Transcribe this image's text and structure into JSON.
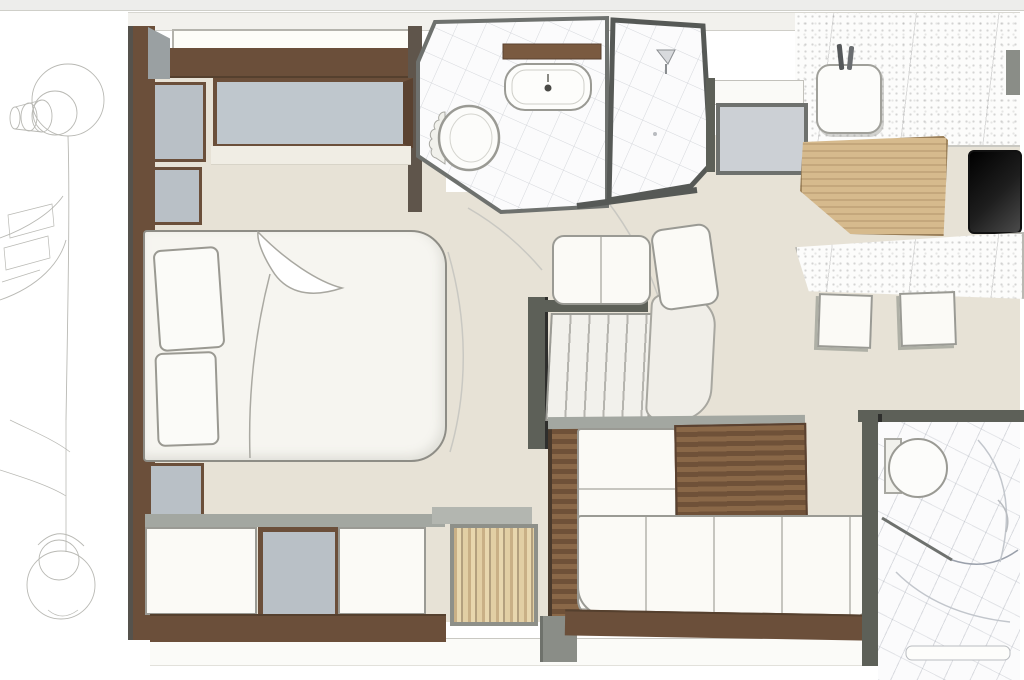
{
  "meta": {
    "title": "Yacht lower deck interior floor plan",
    "diagram_type": "floor-plan",
    "text_content": "none (drawing only)"
  },
  "palette": {
    "page_bg": "#ffffff",
    "top_strip": "#ededeb",
    "floor_beige": "#e7e2d6",
    "hull_band": "#f2f1ed",
    "wall_brown": "#6b4f3a",
    "wall_brown_dark": "#55402e",
    "wall_gray": "#5d6058",
    "panel_gray": "#b9c0c6",
    "hatch_gray": "#ccd0d5",
    "fixture_white": "#fbfaf6",
    "fixture_outline": "#9a9a94",
    "wood_light": "#d6ba8d",
    "wood_mid": "#8a6848",
    "wood_dark": "#6f5138",
    "cooktop_black": "#1c1c1c",
    "sketch_line": "#b9b9b4",
    "counter_speckle": "#fcfcfb",
    "tile_line": "#9aa0ab",
    "shadow_gray": "#a3a7a1"
  },
  "regions": {
    "left_margin": "pencil sketch of bow windlass / anchor gear",
    "forward_cabin": "master cabin with double bed, pillows, wardrobes, vanity mirror, dressers, hanging locker",
    "center_top": "bathroom with toilet, washbasin, wood shelf and separate shower stall",
    "center": "companionway staircase with curved landing",
    "top_right": "galley with sink, speckled stone counter, wood chopping surface, black cooktop, deck hatch",
    "middle_right": "bar counter with two stools",
    "bottom_right": "salon with L-shaped sofa and wood sideboard; guest bathroom with toilet"
  },
  "fixtures": [
    "bow-windlass-sketch",
    "double-bed",
    "pillow",
    "sheet-fold",
    "nightstand",
    "wardrobe-panel",
    "headboard-panel",
    "vanity-mirror",
    "dresser",
    "hanging-locker",
    "toilet",
    "washbasin",
    "wash-shelf",
    "shower-stall",
    "shower-head",
    "staircase",
    "stair-landing",
    "deck-hatch",
    "galley-sink",
    "galley-counter",
    "chopping-board",
    "cooktop",
    "bar-counter",
    "bar-stool",
    "l-shaped-sofa",
    "wood-sideboard",
    "guest-toilet",
    "guest-bath-floor"
  ]
}
